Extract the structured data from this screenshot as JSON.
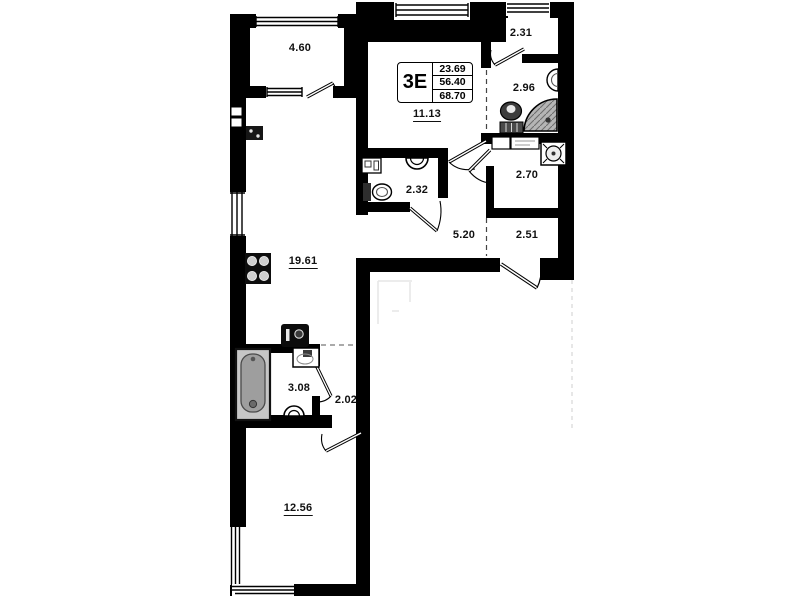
{
  "plan": {
    "title_block": {
      "type_label": "3Е",
      "living_area": "23.69",
      "apartment_area": "56.40",
      "total_area": "68.70"
    },
    "rooms": [
      {
        "name": "balcony",
        "area": "4.60"
      },
      {
        "name": "bedroom-upper",
        "area": "11.13"
      },
      {
        "name": "wardrobe",
        "area": "2.31"
      },
      {
        "name": "shower-room",
        "area": "2.96"
      },
      {
        "name": "wc",
        "area": "2.32"
      },
      {
        "name": "laundry",
        "area": "2.70"
      },
      {
        "name": "hallway",
        "area": "5.20"
      },
      {
        "name": "entry",
        "area": "2.51"
      },
      {
        "name": "kitchen-living",
        "area": "19.61"
      },
      {
        "name": "bathroom",
        "area": "3.08"
      },
      {
        "name": "hall",
        "area": "2.02"
      },
      {
        "name": "bedroom-lower",
        "area": "12.56"
      }
    ],
    "fixtures": [
      "stove-icon",
      "bathtub-icon",
      "washbasin-icon",
      "toilet-icon",
      "shower-tray-icon",
      "washing-machine-icon",
      "wall-sink-icon",
      "water-heater-icon",
      "vent-box-icon"
    ],
    "colors": {
      "wall": "#000000",
      "background": "#ffffff",
      "tub_fill": "#c6c6c6",
      "shower_fill": "#b5b5b5",
      "toilet_dark": "#3c3c3c"
    }
  }
}
